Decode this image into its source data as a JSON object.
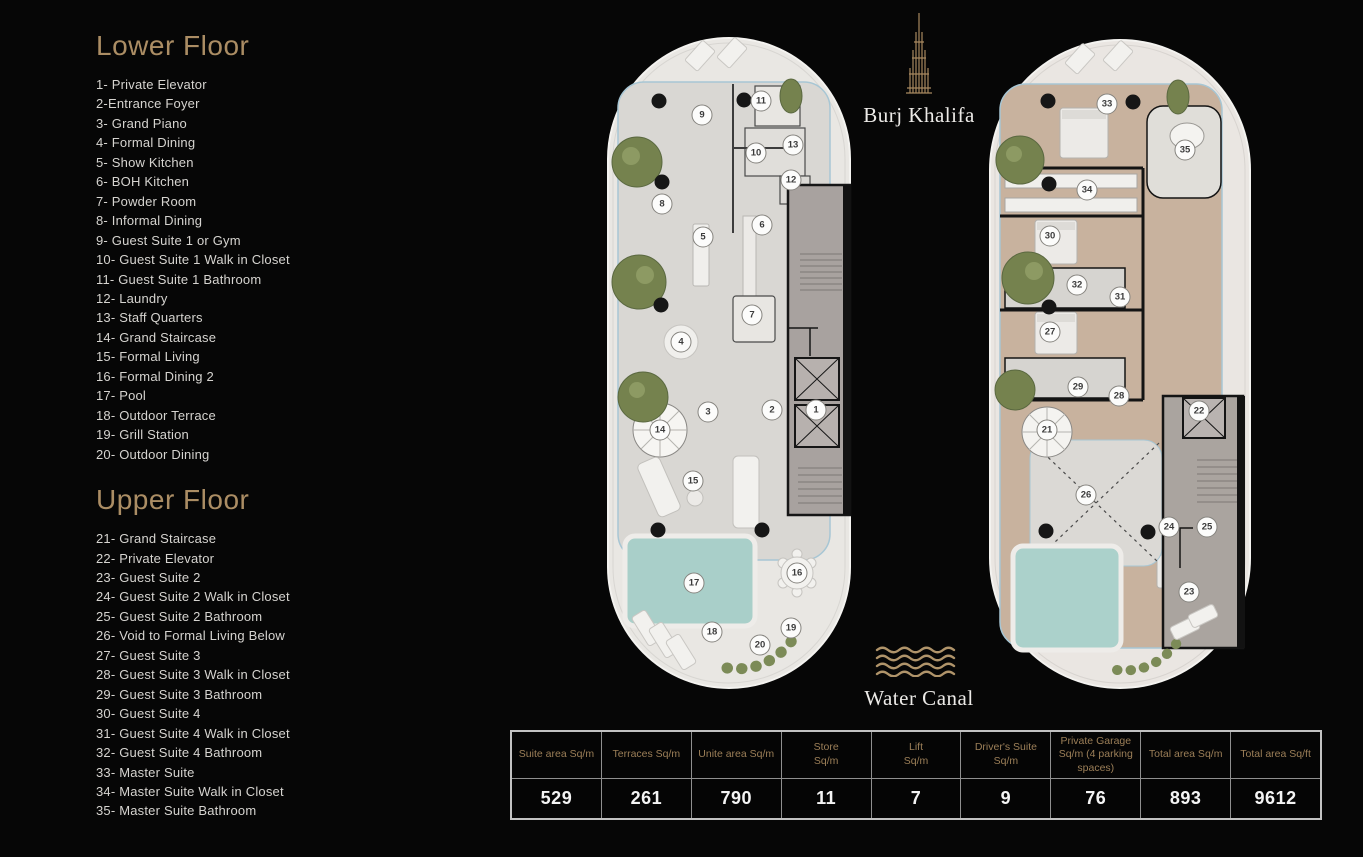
{
  "colors": {
    "background": "#060606",
    "accent_gold": "#ab8d64",
    "list_text": "#d6d4d0",
    "table_header_text": "#9c7f58",
    "table_value_text": "#f4f4f4",
    "pool_teal": "#a9cfc9",
    "lower_floor_fill": "#d9d7d3",
    "upper_floor_fill": "#c8b29e",
    "plant_green": "#75824e"
  },
  "legend": {
    "lower": {
      "title": "Lower Floor",
      "items": [
        "1- Private Elevator",
        "2-Entrance Foyer",
        "3- Grand Piano",
        "4- Formal Dining",
        "5- Show Kitchen",
        "6- BOH Kitchen",
        "7- Powder Room",
        "8- Informal Dining",
        "9- Guest Suite 1 or Gym",
        "10- Guest Suite 1 Walk in Closet",
        "11- Guest Suite 1 Bathroom",
        "12- Laundry",
        "13- Staff Quarters",
        "14- Grand Staircase",
        "15- Formal Living",
        "16- Formal Dining 2",
        "17- Pool",
        "18- Outdoor Terrace",
        "19- Grill Station",
        "20- Outdoor Dining"
      ]
    },
    "upper": {
      "title": "Upper Floor",
      "items": [
        "21- Grand Staircase",
        "22- Private Elevator",
        "23- Guest Suite 2",
        "24- Guest Suite 2 Walk in Closet",
        "25- Guest Suite 2 Bathroom",
        "26- Void to Formal Living Below",
        "27- Guest Suite 3",
        "28- Guest Suite 3 Walk in Closet",
        "29- Guest Suite 3 Bathroom",
        "30- Guest Suite 4",
        "31- Guest Suite 4 Walk in Closet",
        "32- Guest Suite 4 Bathroom",
        "33- Master Suite",
        "34- Master Suite Walk in Closet",
        "35- Master Suite Bathroom"
      ]
    }
  },
  "landmarks": {
    "burj_khalifa": "Burj Khalifa",
    "water_canal": "Water Canal"
  },
  "plans": {
    "lower": {
      "markers": [
        {
          "n": "1",
          "x": 816,
          "y": 410
        },
        {
          "n": "2",
          "x": 772,
          "y": 410
        },
        {
          "n": "3",
          "x": 708,
          "y": 412
        },
        {
          "n": "4",
          "x": 681,
          "y": 342
        },
        {
          "n": "5",
          "x": 703,
          "y": 237
        },
        {
          "n": "6",
          "x": 762,
          "y": 225
        },
        {
          "n": "7",
          "x": 752,
          "y": 315
        },
        {
          "n": "8",
          "x": 662,
          "y": 204
        },
        {
          "n": "9",
          "x": 702,
          "y": 115
        },
        {
          "n": "10",
          "x": 756,
          "y": 153
        },
        {
          "n": "11",
          "x": 761,
          "y": 101
        },
        {
          "n": "12",
          "x": 791,
          "y": 180
        },
        {
          "n": "13",
          "x": 793,
          "y": 145
        },
        {
          "n": "14",
          "x": 660,
          "y": 430
        },
        {
          "n": "15",
          "x": 693,
          "y": 481
        },
        {
          "n": "16",
          "x": 797,
          "y": 573
        },
        {
          "n": "17",
          "x": 694,
          "y": 583
        },
        {
          "n": "18",
          "x": 712,
          "y": 632
        },
        {
          "n": "19",
          "x": 791,
          "y": 628
        },
        {
          "n": "20",
          "x": 760,
          "y": 645
        }
      ]
    },
    "upper": {
      "markers": [
        {
          "n": "21",
          "x": 1047,
          "y": 430
        },
        {
          "n": "22",
          "x": 1199,
          "y": 411
        },
        {
          "n": "23",
          "x": 1189,
          "y": 592
        },
        {
          "n": "24",
          "x": 1169,
          "y": 527
        },
        {
          "n": "25",
          "x": 1207,
          "y": 527
        },
        {
          "n": "26",
          "x": 1086,
          "y": 495
        },
        {
          "n": "27",
          "x": 1050,
          "y": 332
        },
        {
          "n": "28",
          "x": 1119,
          "y": 396
        },
        {
          "n": "29",
          "x": 1078,
          "y": 387
        },
        {
          "n": "30",
          "x": 1050,
          "y": 236
        },
        {
          "n": "31",
          "x": 1120,
          "y": 297
        },
        {
          "n": "32",
          "x": 1077,
          "y": 285
        },
        {
          "n": "33",
          "x": 1107,
          "y": 104
        },
        {
          "n": "34",
          "x": 1087,
          "y": 190
        },
        {
          "n": "35",
          "x": 1185,
          "y": 150
        }
      ]
    }
  },
  "area_table": {
    "columns": [
      {
        "header": "Suite area Sq/m",
        "value": "529"
      },
      {
        "header": "Terraces Sq/m",
        "value": "261"
      },
      {
        "header": "Unite area Sq/m",
        "value": "790"
      },
      {
        "header": "Store\nSq/m",
        "value": "11"
      },
      {
        "header": "Lift\nSq/m",
        "value": "7"
      },
      {
        "header": "Driver's Suite\nSq/m",
        "value": "9"
      },
      {
        "header": "Private Garage\nSq/m (4 parking\nspaces)",
        "value": "76"
      },
      {
        "header": "Total area Sq/m",
        "value": "893"
      },
      {
        "header": "Total area Sq/ft",
        "value": "9612"
      }
    ]
  }
}
